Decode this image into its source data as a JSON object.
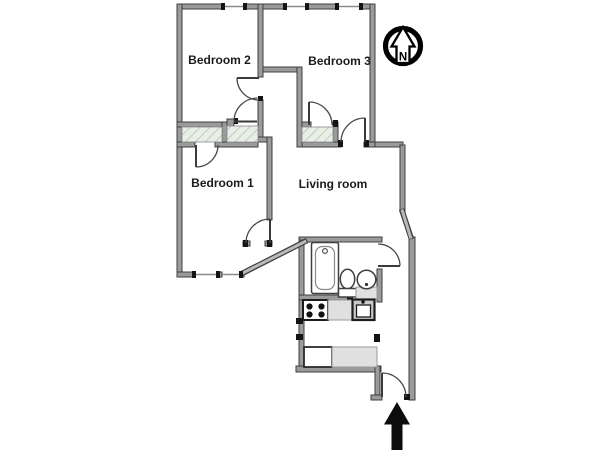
{
  "plan": {
    "rooms": {
      "bedroom1": {
        "label": "Bedroom 1"
      },
      "bedroom2": {
        "label": "Bedroom 2"
      },
      "bedroom3": {
        "label": "Bedroom 3"
      },
      "living_room": {
        "label": "Living room"
      }
    },
    "compass": {
      "letter": "N",
      "meaning": "north"
    },
    "entrance": {
      "symbol": "entrance-arrow"
    },
    "icons": {
      "bathtub": "bathtub-icon",
      "toilet": "toilet-icon",
      "bathroom_sink": "bathroom-sink-icon",
      "stove": "stove-icon",
      "kitchen_sink": "kitchen-sink-icon",
      "refrigerator": "refrigerator-icon",
      "kitchen_counter": "kitchen-counter-icon"
    },
    "colors": {
      "wall": "#9b9b9b",
      "wall_edge": "#3f3f3f",
      "jamb": "#141414",
      "hatch_fill": "#e9efe7",
      "hatch_line": "#b3c4af",
      "counter_fill": "#e0e0e0",
      "background": "#ffffff",
      "text": "#1c1c1c"
    }
  }
}
